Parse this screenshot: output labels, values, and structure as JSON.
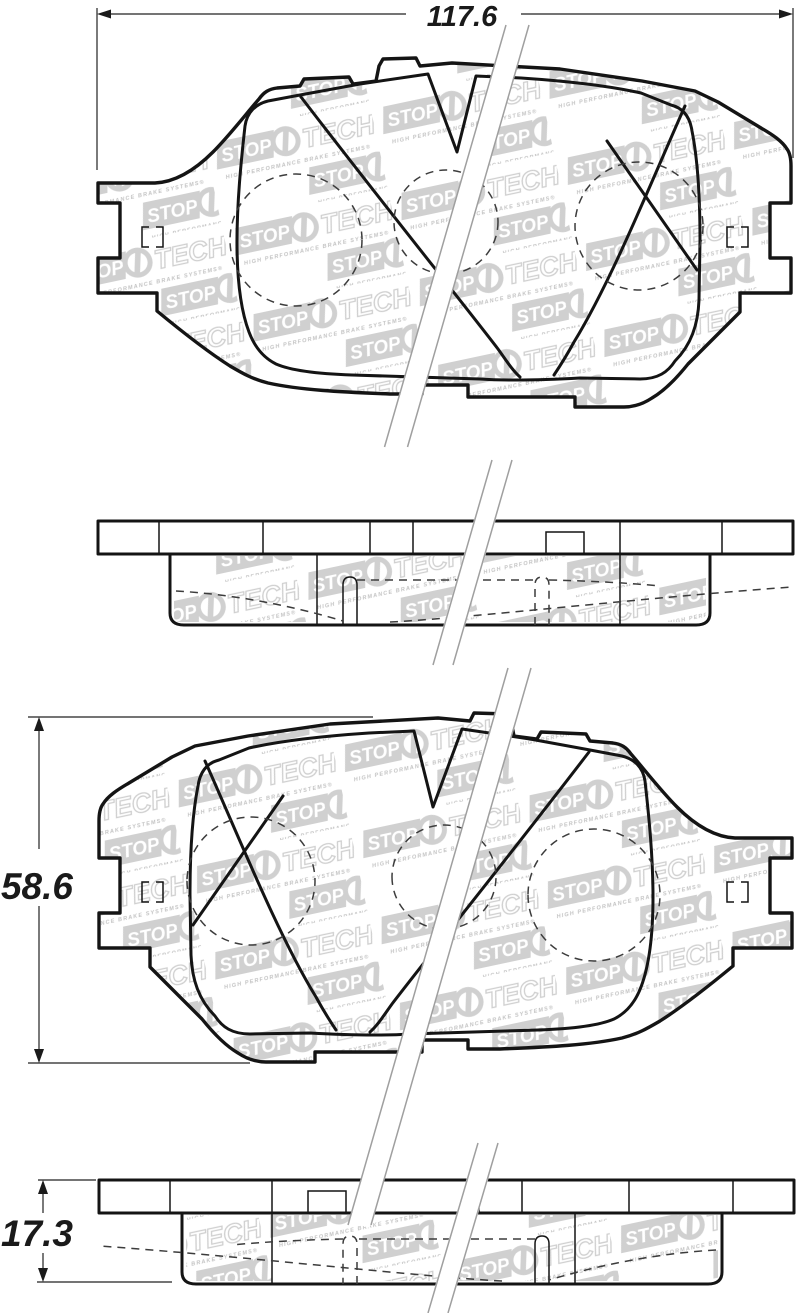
{
  "drawing": {
    "type": "brake-pad dimensional drawing",
    "dimensions": {
      "width": {
        "value": "117.6",
        "applies_to": "pad front view width"
      },
      "height": {
        "value": "58.6",
        "applies_to": "pad front view height"
      },
      "thickness": {
        "value": "17.3",
        "applies_to": "pad edge view thickness"
      }
    },
    "watermark": {
      "word1": "STOP",
      "word2": "TECH",
      "tagline": "HIGH PERFORMANCE BRAKE SYSTEMS®"
    },
    "colors": {
      "line": "#141414",
      "watermark_gray": "#d0d0d0",
      "break_line_gray": "#9f9f9f",
      "background": "#ffffff"
    },
    "views": [
      {
        "name": "front view pad 1"
      },
      {
        "name": "edge view pad 1"
      },
      {
        "name": "front view pad 2 (mirrored)"
      },
      {
        "name": "edge view pad 2 (mirrored)"
      }
    ]
  }
}
